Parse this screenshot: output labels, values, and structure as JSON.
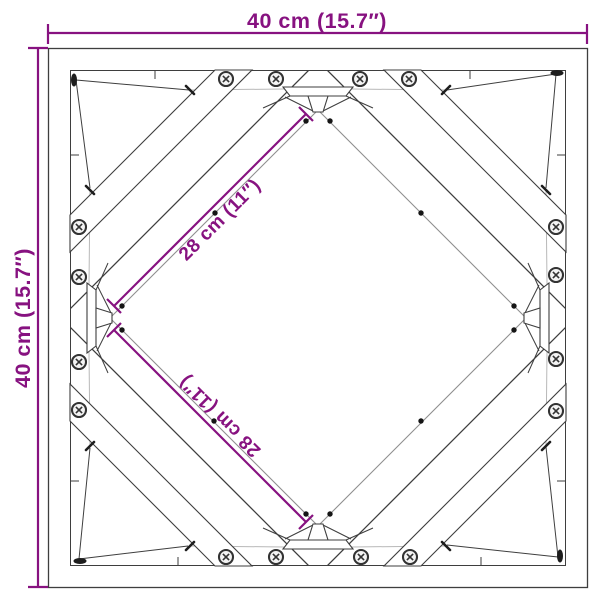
{
  "diagram": {
    "width_dimension": "40 cm (15.7″)",
    "height_dimension": "40 cm (15.7″)",
    "diagonal_dimension_upper": "28 cm (11″)",
    "diagonal_dimension_lower": "28 cm (11″)"
  },
  "colors": {
    "dimension": "#871280",
    "line": "#3E3E3E",
    "light_line": "#B8B8B8",
    "inner_line": "#8F8F8F",
    "background": "#FFFFFF"
  }
}
